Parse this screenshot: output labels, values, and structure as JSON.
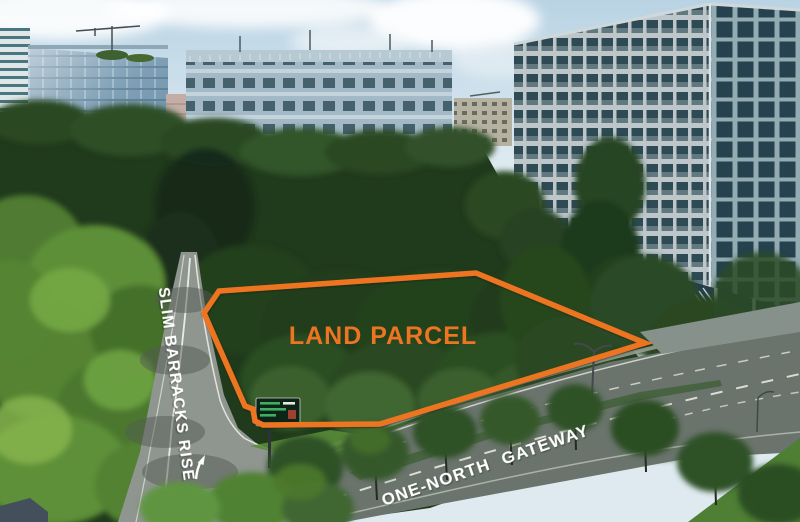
{
  "annotations": {
    "parcel_label": "LAND PARCEL",
    "road_label_left": "SLIM BARRACKS RISE",
    "road_label_bottom": "ONE-NORTH GATEWAY"
  },
  "colors": {
    "parcel_outline": "#ED7421",
    "parcel_label": "#ED7421",
    "road_label": "#FFFFFF",
    "road_marking": "#F2F3EE"
  },
  "icons": {
    "road_direction_arrow": "curved-up-arrow-road-marking"
  }
}
